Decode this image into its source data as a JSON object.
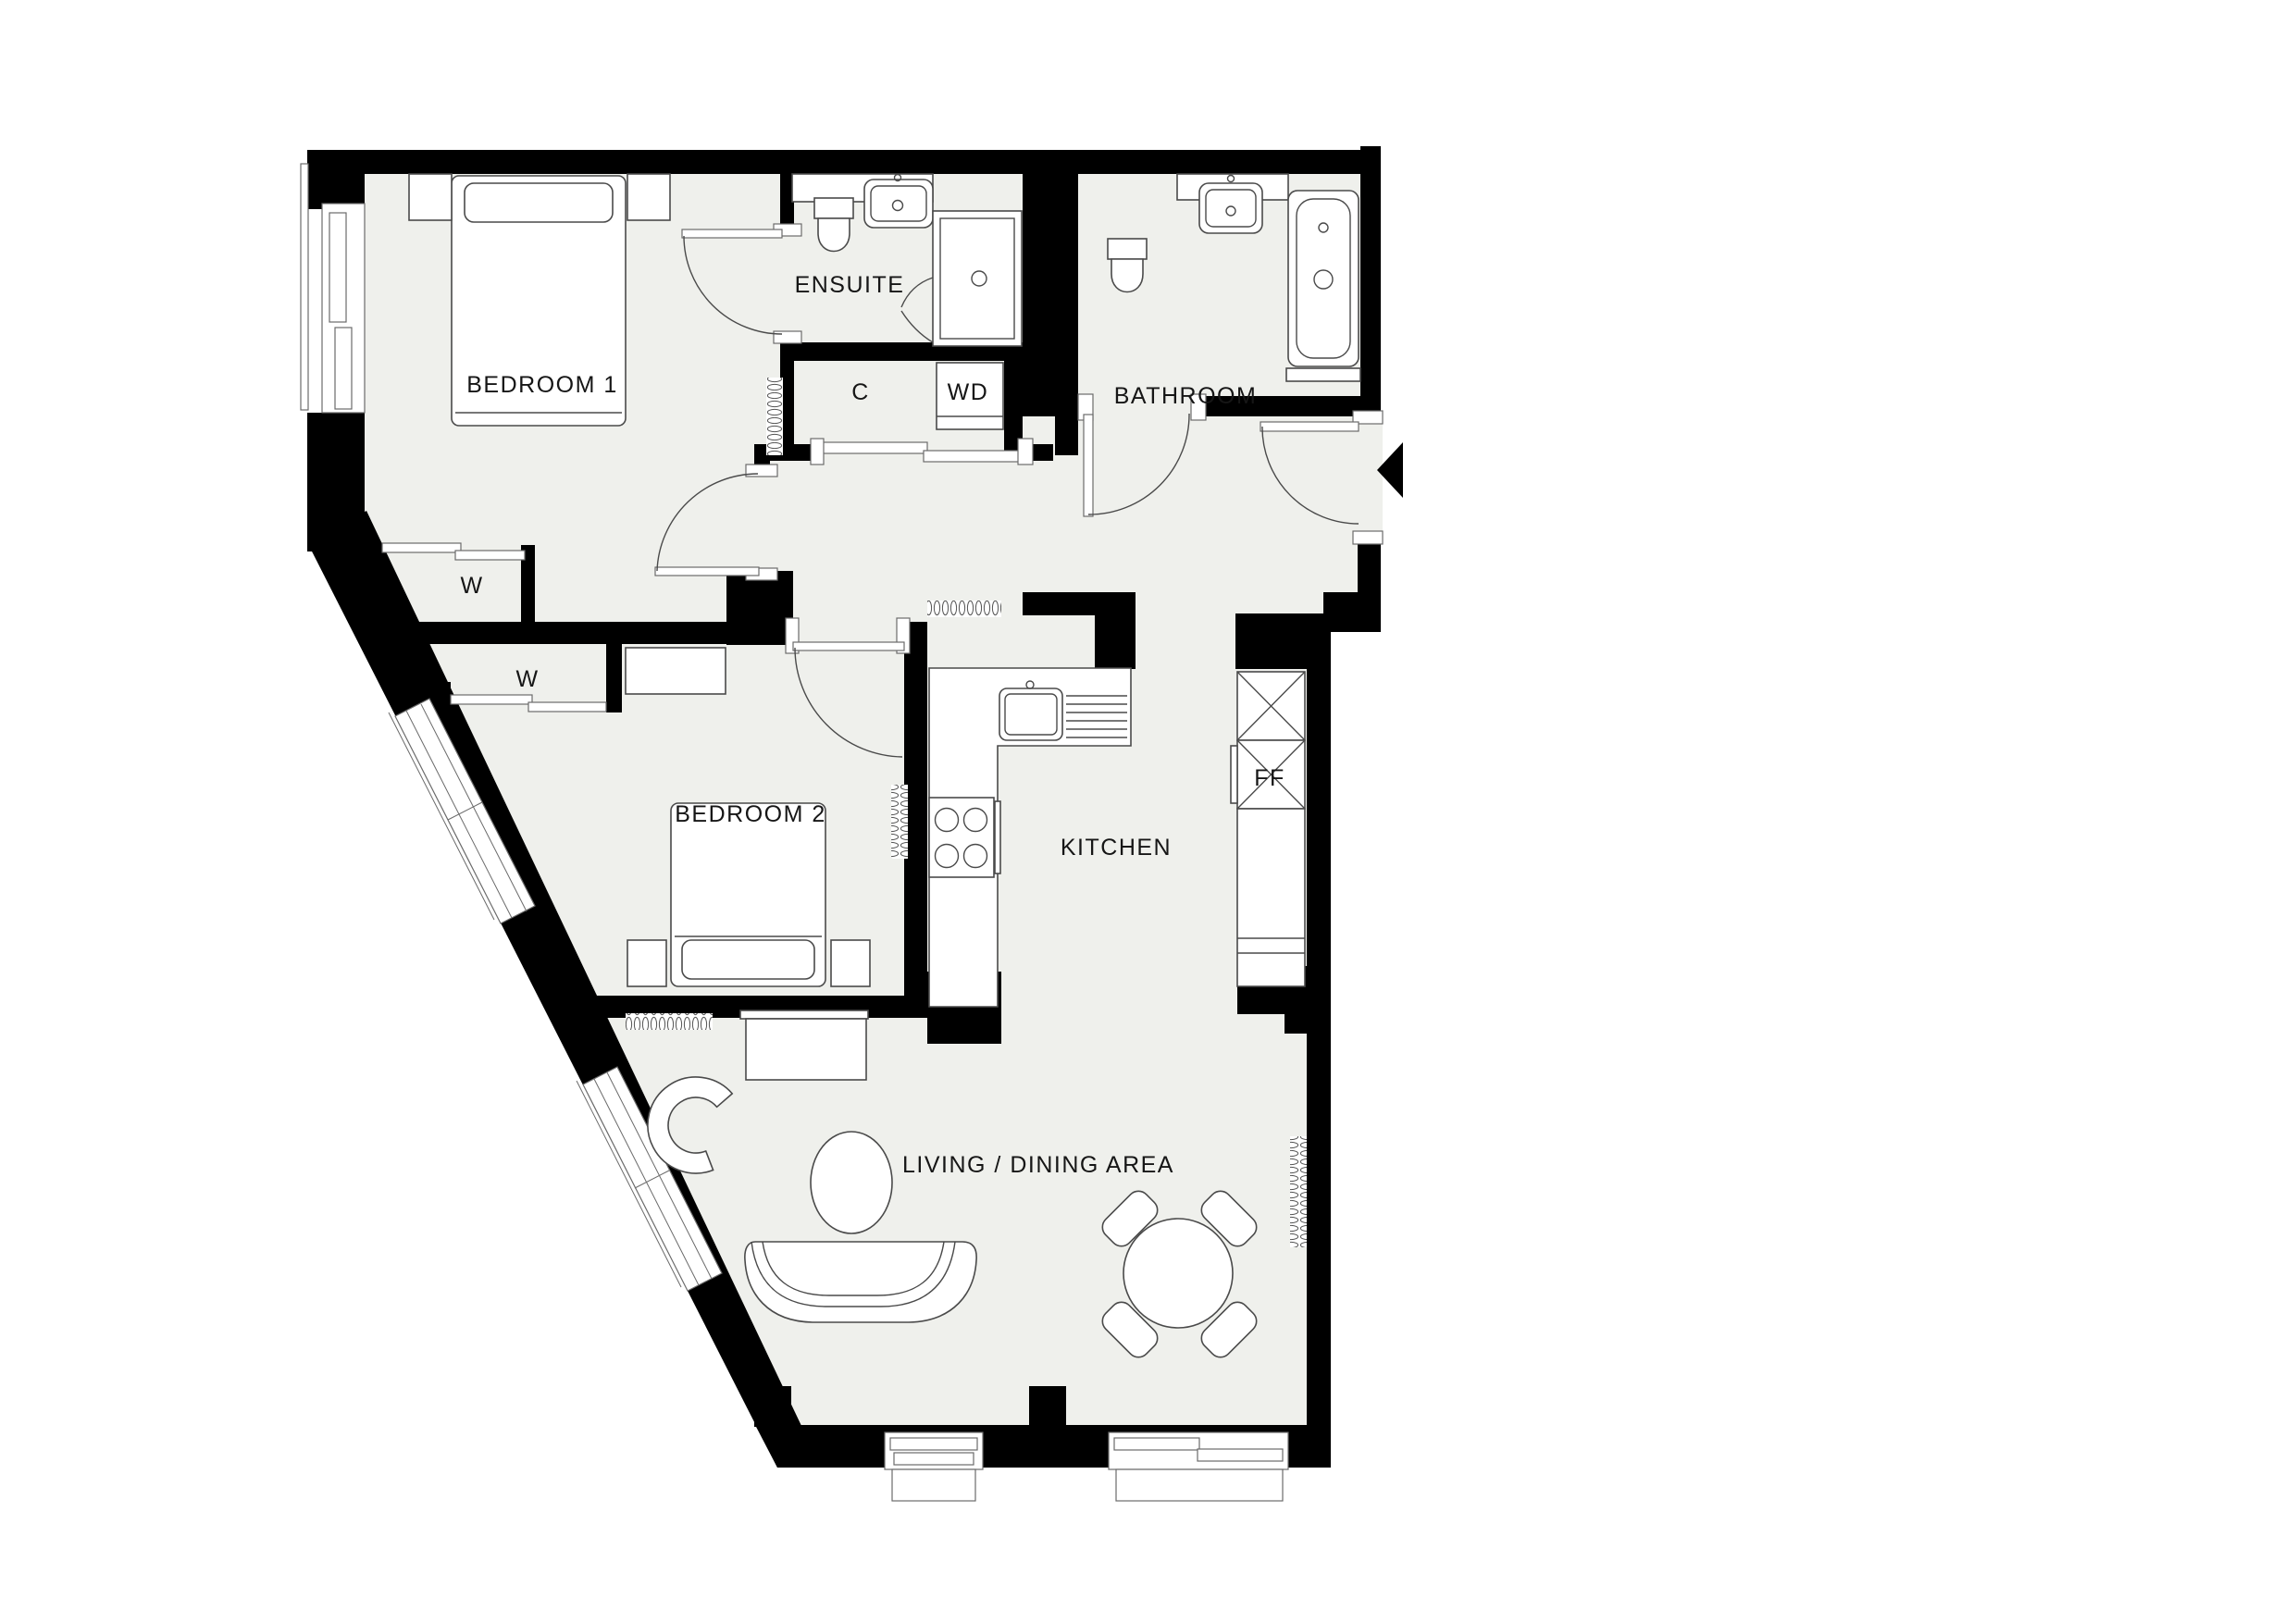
{
  "plan": {
    "colors": {
      "background": "#ffffff",
      "floor": "#eff0ec",
      "wall": "#000000",
      "furniture_line": "#4a4a4a"
    },
    "labels": [
      {
        "id": "bedroom-1",
        "text": "BEDROOM 1"
      },
      {
        "id": "ensuite",
        "text": "ENSUITE"
      },
      {
        "id": "bathroom",
        "text": "BATHROOM"
      },
      {
        "id": "cupboard",
        "text": "C"
      },
      {
        "id": "washer-dryer",
        "text": "WD"
      },
      {
        "id": "wardrobe-1",
        "text": "W"
      },
      {
        "id": "wardrobe-2",
        "text": "W"
      },
      {
        "id": "bedroom-2",
        "text": "BEDROOM 2"
      },
      {
        "id": "kitchen",
        "text": "KITCHEN"
      },
      {
        "id": "fridge-freezer",
        "text": "FF"
      },
      {
        "id": "living-dining",
        "text": "LIVING / DINING AREA"
      }
    ]
  }
}
